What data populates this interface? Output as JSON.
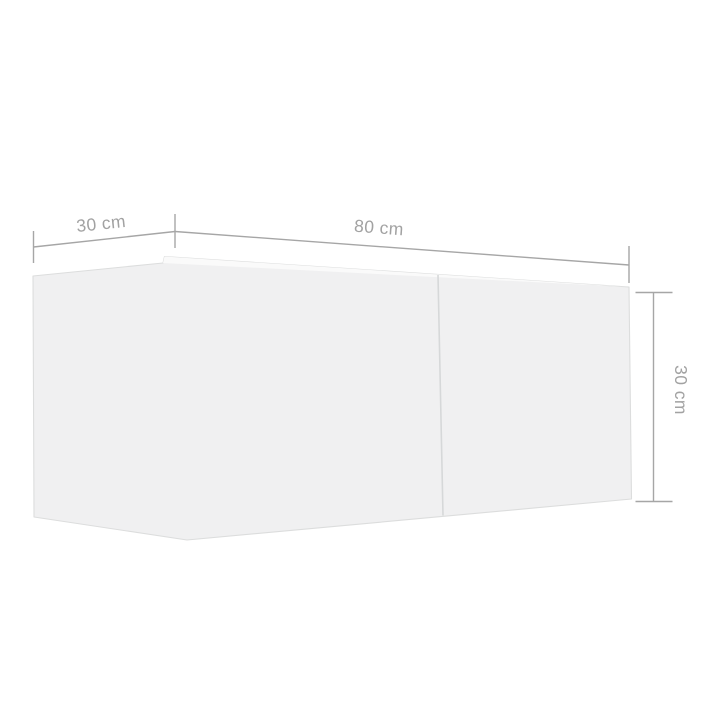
{
  "image": {
    "type": "product-dimension-diagram",
    "subject": "wall-mounted TV cabinet with two door sections, perspective view",
    "background": "#ffffff"
  },
  "colors": {
    "dimension_line": "#a6a6a6",
    "dimension_text": "#a2a2a2",
    "cabinet_fill": "#f0f0f1",
    "cabinet_top_face": "#fafafa",
    "cabinet_outline": "#dcdddd",
    "door_divider": "#d6d8d9"
  },
  "dimensions": [
    {
      "id": "depth",
      "value": 30,
      "unit": "cm",
      "label": "30 cm"
    },
    {
      "id": "width",
      "value": 80,
      "unit": "cm",
      "label": "80 cm"
    },
    {
      "id": "height",
      "value": 30,
      "unit": "cm",
      "label": "30 cm"
    }
  ]
}
